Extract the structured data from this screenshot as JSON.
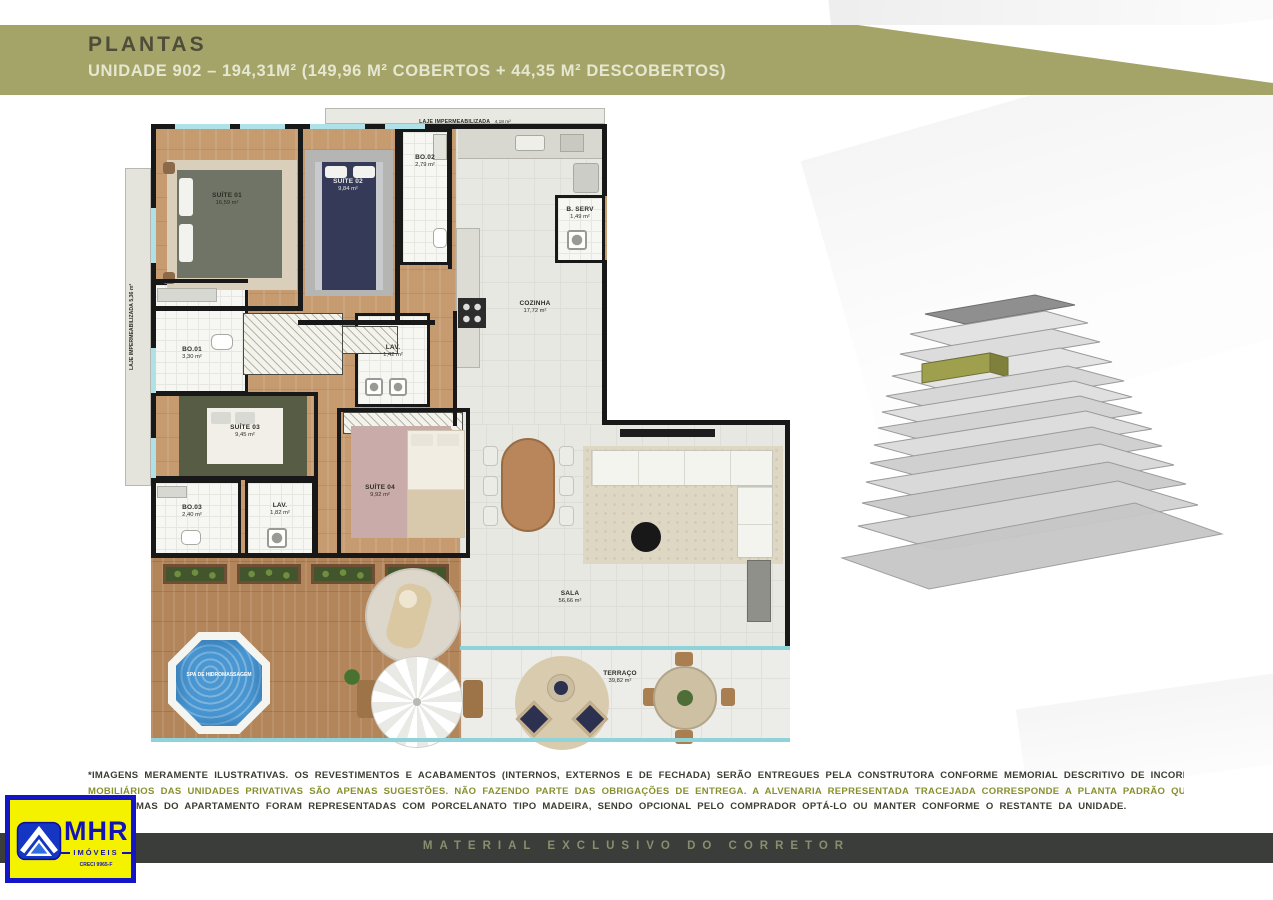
{
  "header": {
    "title": "PLANTAS",
    "subtitle": "UNIDADE 902 –  194,31M² (149,96 M² COBERTOS + 44,35 M² DESCOBERTOS)"
  },
  "plan": {
    "rooms": {
      "laje_top": {
        "name": "LAJE IMPERMEABILIZADA",
        "area": "4,18 m²"
      },
      "laje_left": {
        "name": "LAJE IMPERMEABILIZADA",
        "area": "5,36 m²"
      },
      "suite01": {
        "name": "SUÍTE 01",
        "area": "16,59 m²"
      },
      "suite02": {
        "name": "SUÍTE 02",
        "area": "9,84 m²"
      },
      "bo02": {
        "name": "BO.02",
        "area": "2,79 m²"
      },
      "bserv": {
        "name": "B. SERV",
        "area": "1,49 m²"
      },
      "cozinha": {
        "name": "COZINHA",
        "area": "17,72 m²"
      },
      "bo01": {
        "name": "BO.01",
        "area": "3,30 m²"
      },
      "lav01": {
        "name": "LAV.",
        "area": "1,42 m²"
      },
      "suite03": {
        "name": "SUÍTE 03",
        "area": "9,45 m²"
      },
      "bo03": {
        "name": "BO.03",
        "area": "2,40 m²"
      },
      "lav02": {
        "name": "LAV.",
        "area": "1,82 m²"
      },
      "suite04": {
        "name": "SUÍTE 04",
        "area": "9,92 m²"
      },
      "sala": {
        "name": "SALA",
        "area": "56,66 m²"
      },
      "terraco": {
        "name": "TERRAÇO",
        "area": "39,82 m²"
      },
      "spa": {
        "name": "SPA DE HIDROMASSAGEM"
      }
    }
  },
  "disclaimer": {
    "lines": [
      "*IMAGENS MERAMENTE ILUSTRATIVAS. OS REVESTIMENTOS E ACABAMENTOS (INTERNOS, EXTERNOS E DE FECHADA) SERÃO ENTREGUES PELA CONSTRUTORA CONFORME MEMORIAL DESCRITIVO DE INCORPORAÇÃO. A DECORAÇÃO, EQUIPAMENTOS E",
      "MOBILIÁRIOS DAS UNIDADES PRIVATIVAS SÃO APENAS SUGESTÕES. NÃO FAZENDO PARTE DAS OBRIGAÇÕES DE ENTREGA. A ALVENARIA REPRESENTADA TRACEJADA CORRESPONDE A PLANTA PADRÃO QUE SERÁ ENTREGUE PELA CONSTRUTORA. AS",
      "MAS DO APARTAMENTO FORAM REPRESENTADAS COM PORCELANATO TIPO MADEIRA, SENDO OPCIONAL PELO COMPRADOR OPTÁ-LO OU MANTER CONFORME O RESTANTE DA UNIDADE."
    ]
  },
  "footer": {
    "bar_text": "MATERIAL EXCLUSIVO DO CORRETOR"
  },
  "logo": {
    "name": "MHR",
    "line": "IMÓVEIS",
    "creci": "CRECI 9965-F"
  },
  "colors": {
    "band_olive": "#a4a469",
    "footer_bar": "#3a3d39",
    "logo_blue": "#1515c8",
    "logo_yellow": "#f5f200",
    "highlight_slab_olive": "#9fa04e"
  }
}
